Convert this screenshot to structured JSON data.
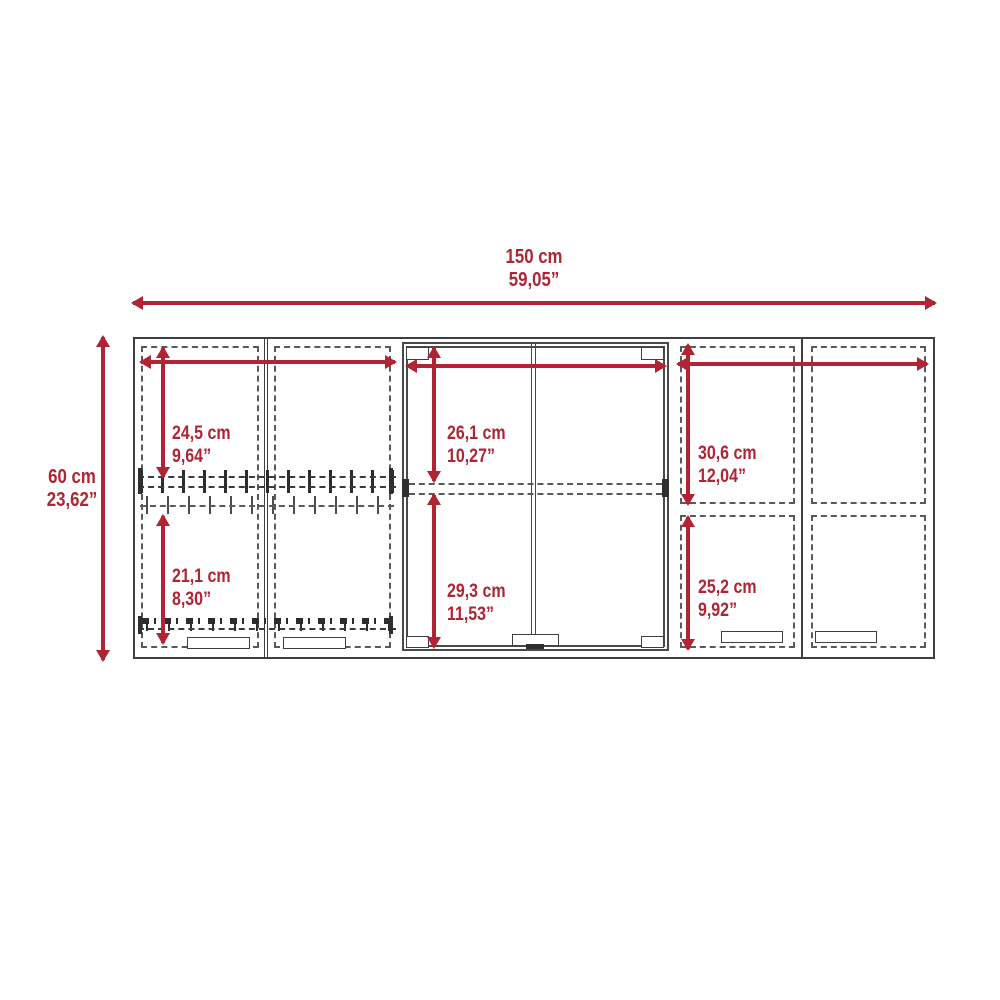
{
  "dims": {
    "overall_width": {
      "cm": "150 cm",
      "inch": "59,05”"
    },
    "overall_height": {
      "cm": "60 cm",
      "inch": "23,62”"
    },
    "left_upper": {
      "cm": "24,5 cm",
      "inch": "9,64”"
    },
    "left_lower": {
      "cm": "21,1 cm",
      "inch": "8,30”"
    },
    "center_upper": {
      "cm": "26,1 cm",
      "inch": "10,27”"
    },
    "center_lower": {
      "cm": "29,3 cm",
      "inch": "11,53”"
    },
    "right_upper": {
      "cm": "30,6 cm",
      "inch": "12,04”"
    },
    "right_lower": {
      "cm": "25,2 cm",
      "inch": "9,92”"
    }
  },
  "colors": {
    "accent_red": "#b02433",
    "line_dark": "#3f3f3f",
    "dash_gray": "#5a5a5a"
  }
}
